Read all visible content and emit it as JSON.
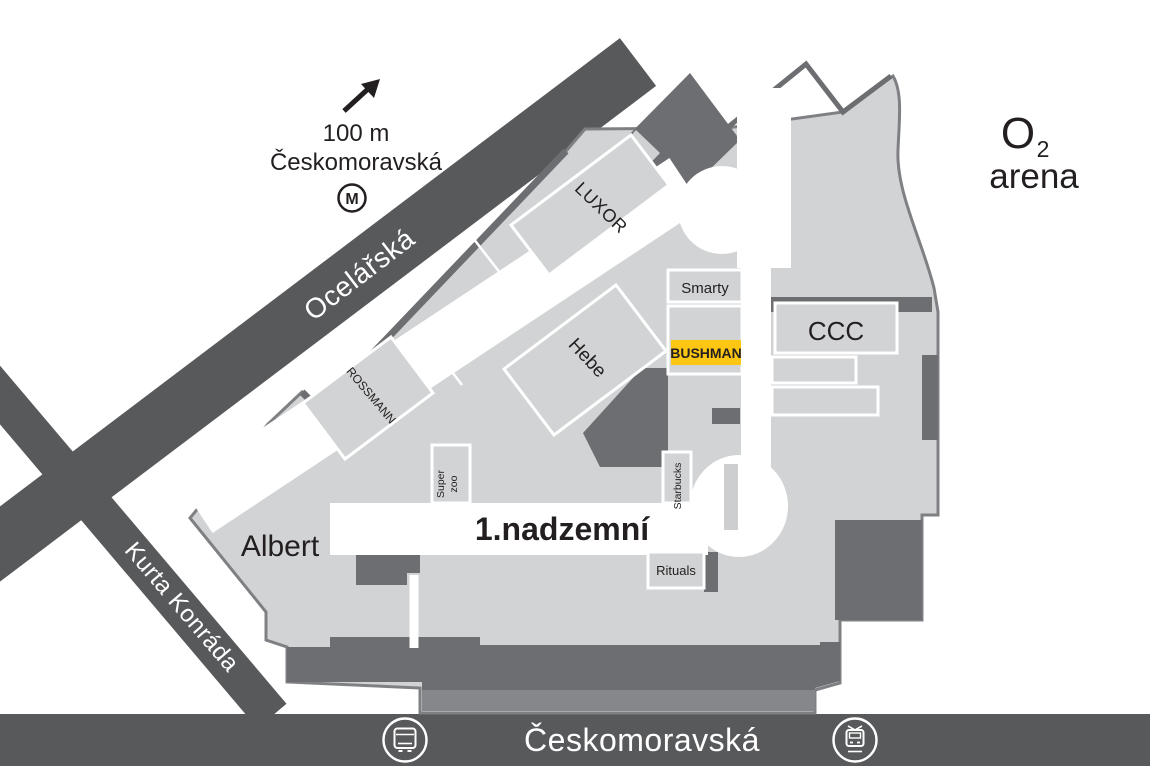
{
  "map_title": "Galerie shopping centre floor plan",
  "floor_label": "1.nadzemní",
  "streets": {
    "ocelarska": "Ocelářská",
    "kurta_konrada": "Kurta Konráda",
    "ceskomoravska_bottom": "Českomoravská"
  },
  "metro": {
    "distance": "100 m",
    "station": "Českomoravská",
    "symbol": "M"
  },
  "arena": {
    "line1_main": "O",
    "line1_sub": "2",
    "line2": "arena"
  },
  "stores": {
    "luxor": "LUXOR",
    "smarty": "Smarty",
    "hebe": "Hebe",
    "bushman": "BUSHMAN",
    "ccc": "CCC",
    "rossmann": "ROSSMANN",
    "super_zoo_line1": "Super",
    "super_zoo_line2": "zoo",
    "starbucks": "Starbucks",
    "rituals": "Rituals",
    "albert": "Albert"
  },
  "icons": [
    "northeast-arrow-icon",
    "metro-icon",
    "bus-icon",
    "tram-icon"
  ],
  "colors": {
    "street_band": "#58595b",
    "building_fill": "#d1d3d4",
    "building_border": "#7e8083",
    "inner_wall": "#6d6e71",
    "highlight_yellow": "#fcc613",
    "text_dark": "#231f20",
    "label_white": "#ffffff"
  }
}
